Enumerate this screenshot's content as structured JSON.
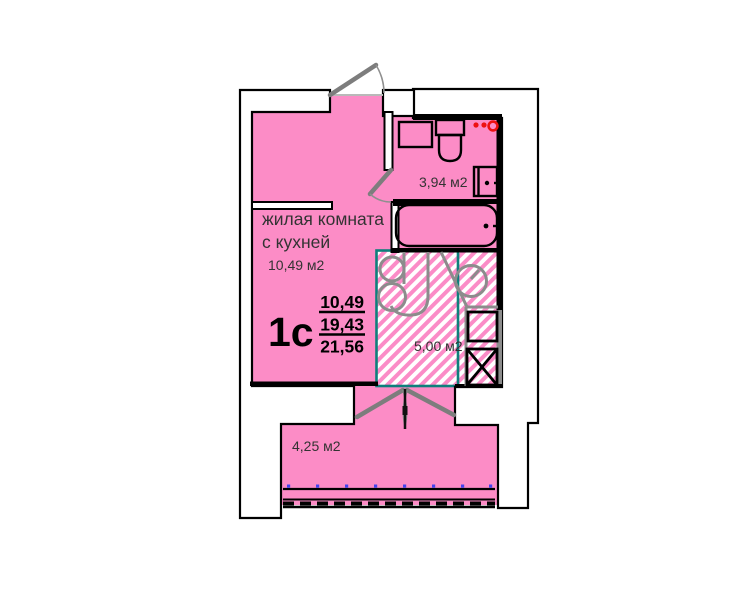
{
  "plan": {
    "unit": {
      "label": "1с",
      "area_living": "10,49",
      "area_main": "19,43",
      "area_total": "21,56"
    },
    "rooms": {
      "living": {
        "name_line1": "жилая комната",
        "name_line2": "с кухней",
        "area": "10,49 м2"
      },
      "bathroom": {
        "area": "3,94 м2"
      },
      "kitchen": {
        "area": "5,00 м2"
      },
      "balcony": {
        "area": "4,25 м2"
      }
    },
    "colors": {
      "room_fill": "#FC8CC6",
      "hatch_stripe": "#FB8CC7",
      "kitchen_border": "#0E7F7C",
      "vent_symbol": "#EE1111",
      "glazing_dots": "#4444EE",
      "fixture_gray": "#8C8C8C",
      "door_gray": "#7D7D7D",
      "wall_outline": "#000000",
      "label_text": "#333333"
    }
  }
}
